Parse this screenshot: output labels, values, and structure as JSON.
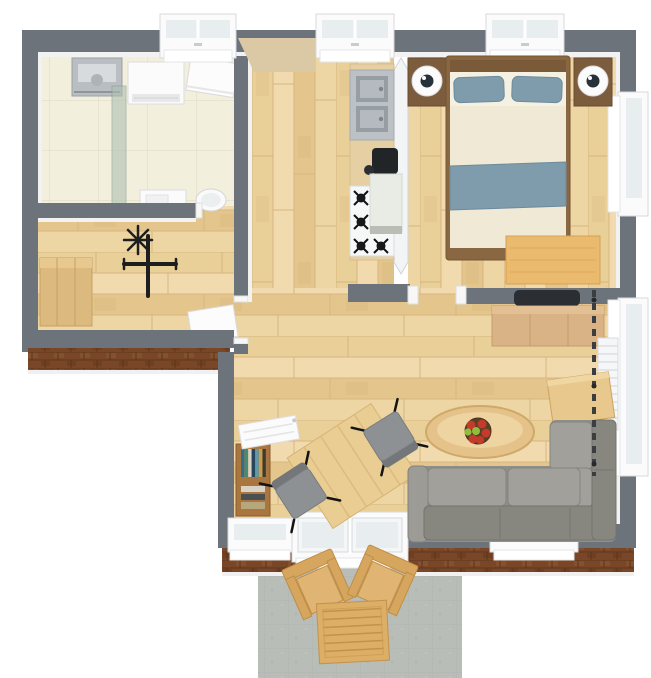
{
  "scene": {
    "type": "3d-floor-plan-render",
    "view": "top-down",
    "background": "#ffffff"
  },
  "rooms": [
    {
      "name": "bathroom",
      "position": "top-left",
      "floor": "cream-tile",
      "furniture": [
        "wall-sink",
        "washing-machine",
        "shower-glass-screen",
        "bath-unit",
        "toilet",
        "open-door",
        "window"
      ]
    },
    {
      "name": "office-gym",
      "position": "mid-left",
      "floor": "light-wood-planks",
      "furniture": [
        "wood-cabinet",
        "exercise-bike",
        "open-door"
      ]
    },
    {
      "name": "hallway-kitchen",
      "position": "center",
      "floor": "light-wood-planks",
      "furniture": [
        "kitchen-counter",
        "double-steel-sink",
        "coffee-maker",
        "gas-stove-four-burners",
        "kitchen-island",
        "window"
      ]
    },
    {
      "name": "bedroom",
      "position": "top-right",
      "floor": "light-wood-planks",
      "furniture": [
        "double-bed",
        "two-blue-pillows",
        "blue-throw-blanket",
        "nightstand-left",
        "nightstand-right",
        "two-round-lamps",
        "desk",
        "top-window",
        "right-window"
      ]
    },
    {
      "name": "living-dining-room",
      "position": "bottom-center-right",
      "floor": "light-wood-planks",
      "furniture": [
        "wall-tv",
        "tv-sideboard",
        "bookshelf",
        "left-radiator",
        "dining-table",
        "two-gray-chairs",
        "oval-coffee-table",
        "fruit-bowl",
        "l-shaped-sofa",
        "console-table",
        "dark-curtain",
        "right-radiator",
        "bottom-window-left",
        "patio-french-door",
        "bottom-window-right",
        "right-window"
      ]
    },
    {
      "name": "patio",
      "position": "bottom-outside",
      "floor": "gray-stone",
      "furniture": [
        "wood-armchair-left",
        "wood-armchair-right",
        "slatted-wood-table"
      ]
    }
  ],
  "palette": {
    "wall": "#6d737b",
    "wall_face": "#f2f2f3",
    "brick": "#7a4628",
    "wood_floor": "#ecd29c",
    "tile_floor": "#f2efdd",
    "patio_floor": "#b9bdb8",
    "appliance_white": "#fbfbfc",
    "steel": "#bcc1c6",
    "shower_glass": "#aebfb2",
    "sofa_base": "#8f8f8a",
    "sofa_seat": "#a1a09b",
    "sofa_back": "#87867f",
    "bed_blue": "#7e9cab",
    "duvet": "#efe9d6",
    "bed_wood": "#8a6743",
    "wood_furniture": "#d9b385",
    "wood_bright": "#eabb6e",
    "patio_wood": "#d6a65f",
    "dark": "#2b2e32",
    "apple_red": "#c63a2c",
    "apple_green": "#8fbe3e",
    "hall_wall_face_tan": "#dbc8a4",
    "book_spines": [
      "#2f6e8c",
      "#3f8d78",
      "#d9d5c6",
      "#25465c",
      "#5d9ab0",
      "#c9a04a",
      "#3a3a36"
    ]
  }
}
